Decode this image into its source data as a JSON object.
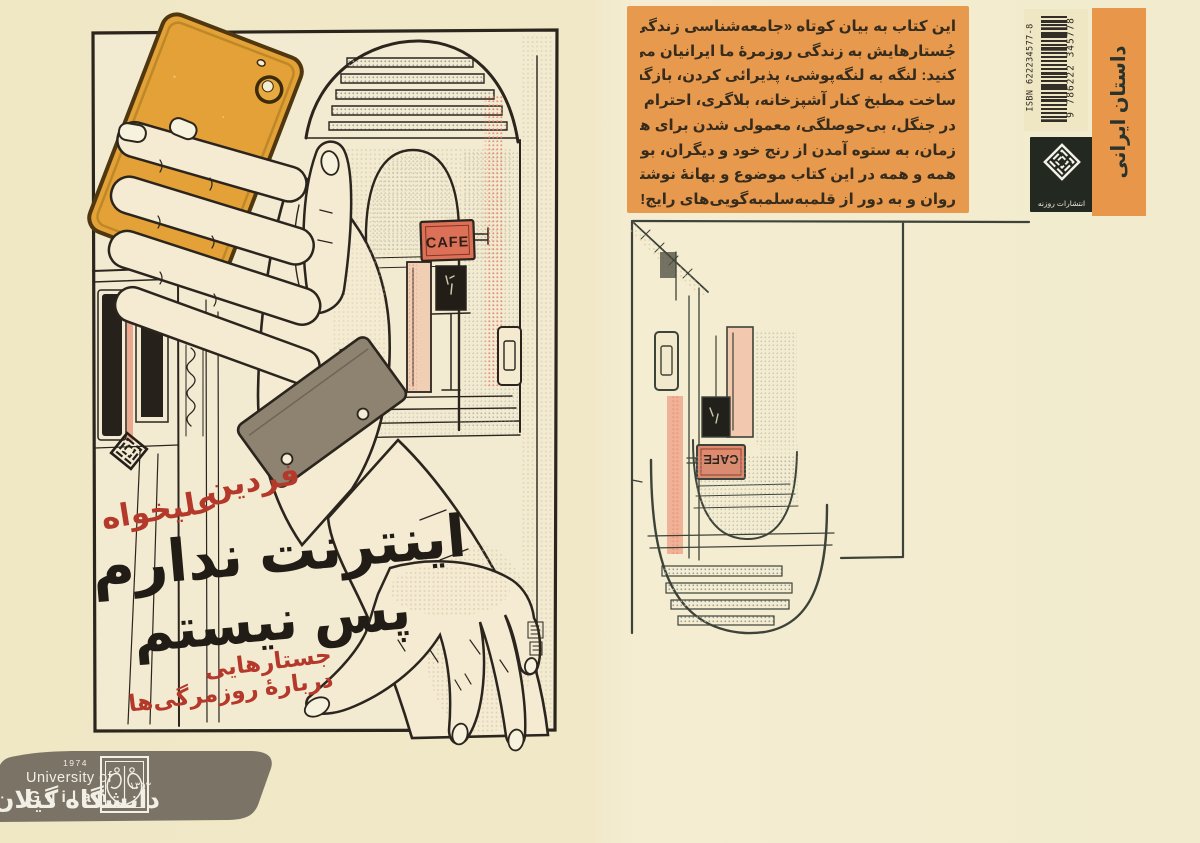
{
  "front_cover": {
    "author_line1": "فردین",
    "author_line2": "علیخواه",
    "title_line1": "اینترنت ندارم",
    "title_line2": "پس نیستم",
    "subtitle_line1": "جستارهایی",
    "subtitle_line2": "دربارهٔ روزمرگی‌ها",
    "cafe_sign": "CAFE"
  },
  "back_cover": {
    "blurb_lines": [
      "این کتاب به بیان کوتاه «جامعه‌شناسی زندگی» است و در همهٔ",
      "جُستارهایش به زندگی روزمرهٔ ما ایرانیان می‌پردازد. به این کلمات دقت",
      "کنید: لنگه به لنگه‌پوشی، پذیرائی کردن، بازگشتن از سفر و فکر به طلاق،",
      "ساخت مطبخ کنار آشپزخانه، بلاگری، احترام به بزرگ‌ترها، میز غذا چیدن",
      "در جنگل، بی‌حوصلگی، معمولی شدن برای هم، عصبانیت از گذر سریع",
      "زمان، به ستوه آمدن از رنج خود و دیگران، بویدن و لمس آجرهای کهنه!",
      "همه و همه در این کتاب موضوع و بهانهٔ نوشتن شده‌اند؛ نوشتاری با نثری",
      "روان و به دور از قلمبه‌سلمبه‌گویی‌های رایج!"
    ],
    "cafe_sign": "CAFE",
    "category_strip": "داستان ایرانی",
    "isbn_label": "ISBN 622234577-8",
    "barcode_number": "9 786222 345778",
    "publisher_name": "انتشارات روزنه"
  },
  "footer": {
    "university_en_line1": "University of",
    "university_en_line2": "Guilan",
    "year_en": "1974",
    "year_fa": "۱۳۵۳",
    "university_fa": "دانشگاه گیلان"
  },
  "colors": {
    "page_background": "#f1e9cb",
    "blurb_background": "#e7994e",
    "category_strip_background": "#e7964a",
    "phone_orange": "#e3a137",
    "accent_red": "#b4392b",
    "cafe_sign_red": "#dc7157",
    "banner_gray": "#7b7466",
    "ink_black": "#2b251e"
  }
}
